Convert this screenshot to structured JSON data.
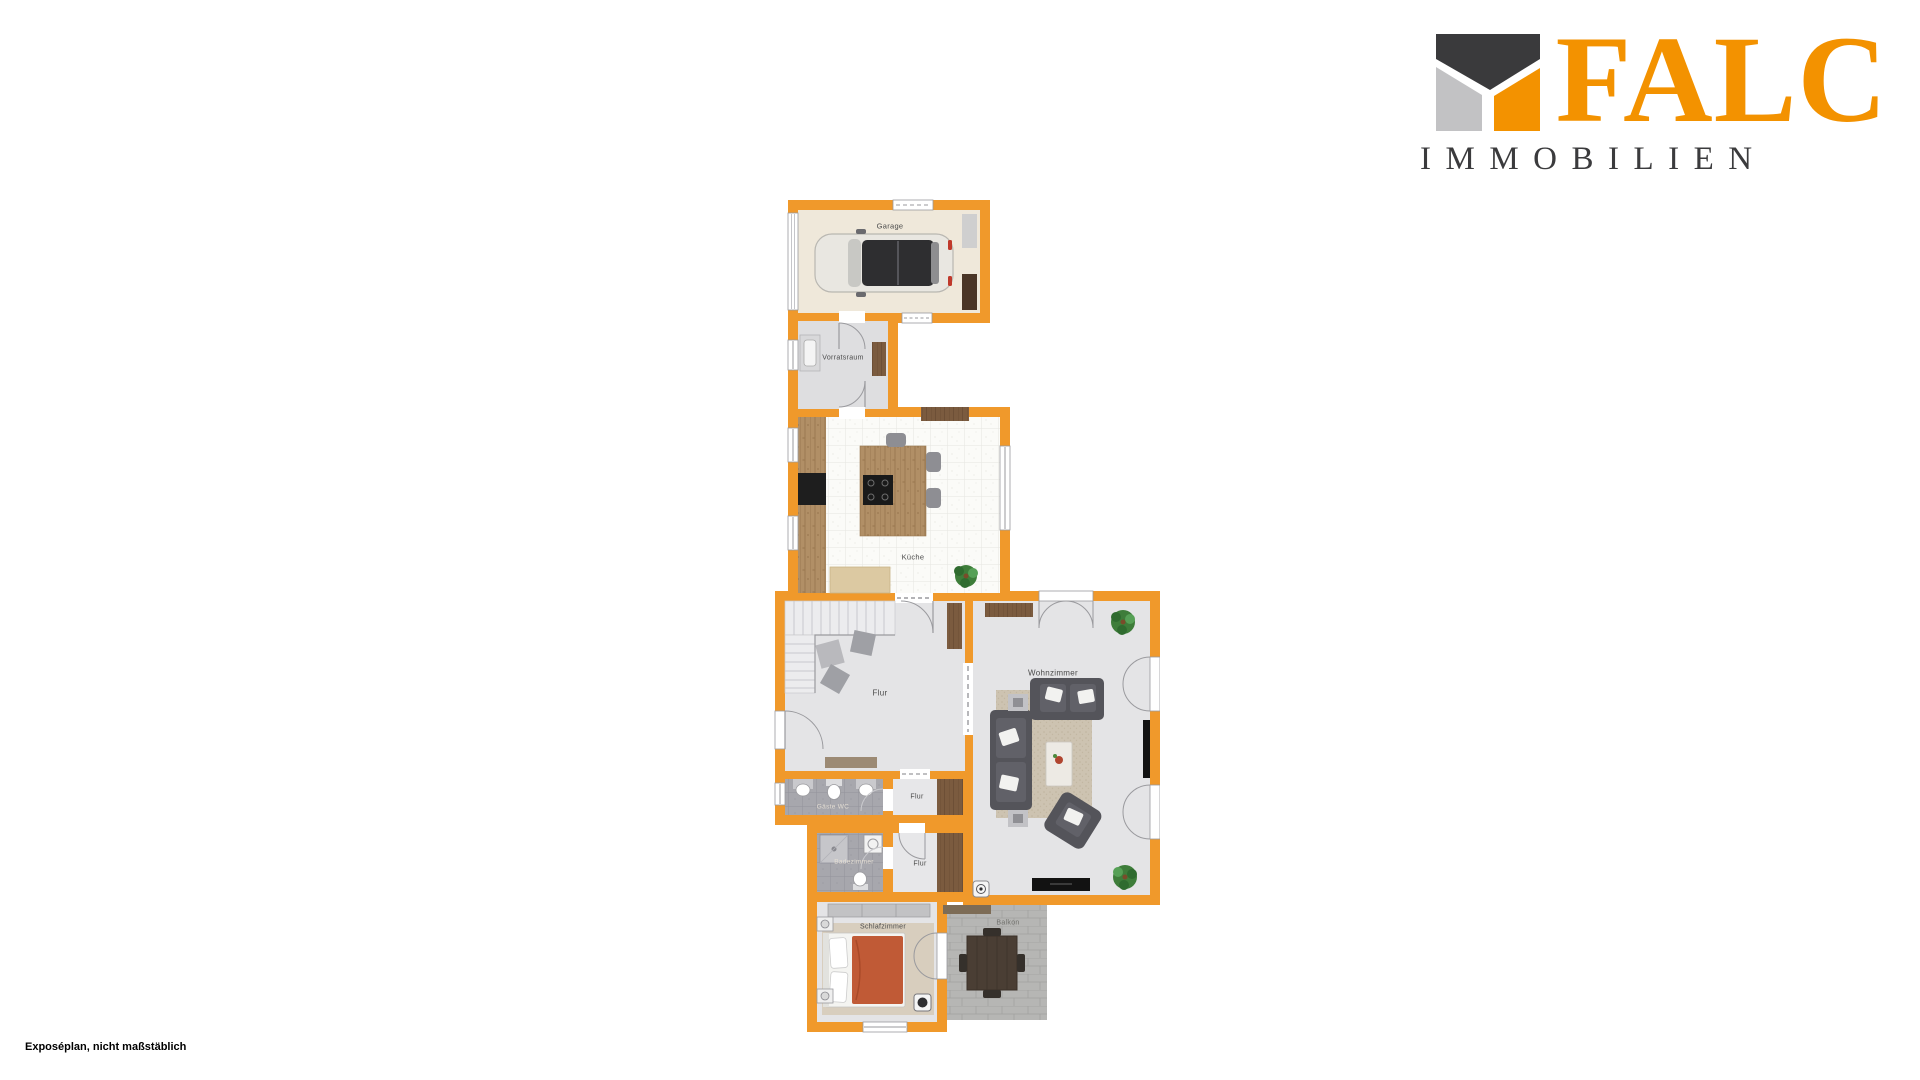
{
  "caption": "Exposéplan, nicht maßstäblich",
  "logo": {
    "brand": "FALC",
    "subtitle": "IMMOBILIEN",
    "colors": {
      "orange": "#F39200",
      "dark": "#3B3B3D",
      "gray": "#C2C2C4"
    }
  },
  "floorplan": {
    "wall_color": "#F0992B",
    "rooms": {
      "garage": "Garage",
      "vorratsraum": "Vorratsraum",
      "kueche": "Küche",
      "flur": "Flur",
      "wohnzimmer": "Wohnzimmer",
      "gaeste_wc": "Gäste WC",
      "flur_klein_1": "Flur",
      "badezimmer": "Badezimmer",
      "flur_klein_2": "Flur",
      "schlafzimmer": "Schlafzimmer",
      "balkon": "Balkon"
    }
  }
}
